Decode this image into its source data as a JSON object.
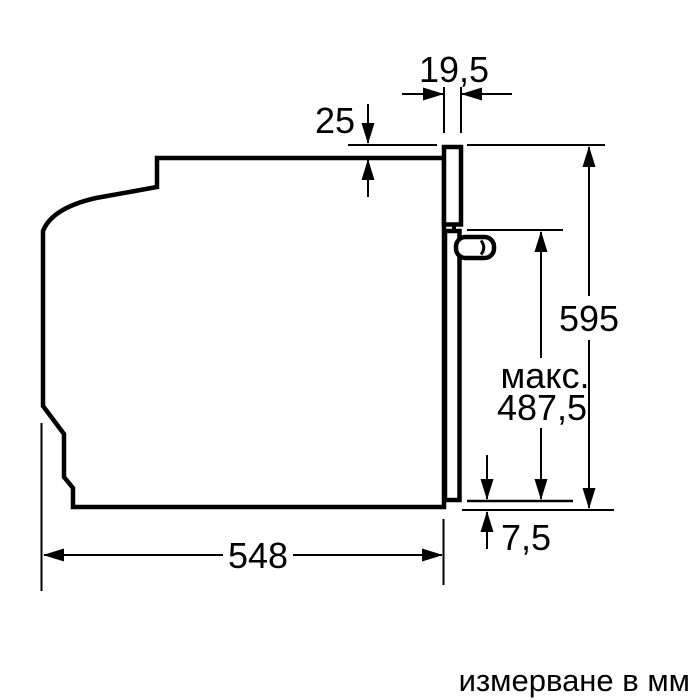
{
  "diagram": {
    "labels": {
      "frame_depth": "19,5",
      "top_clearance": "25",
      "total_height": "595",
      "max_prefix": "макс.",
      "max_height": "487,5",
      "bottom_offset": "7,5",
      "body_depth": "548"
    },
    "footer": {
      "unit_note": "измерване в мм"
    },
    "colors": {
      "line": "#000000",
      "background": "#ffffff"
    }
  }
}
